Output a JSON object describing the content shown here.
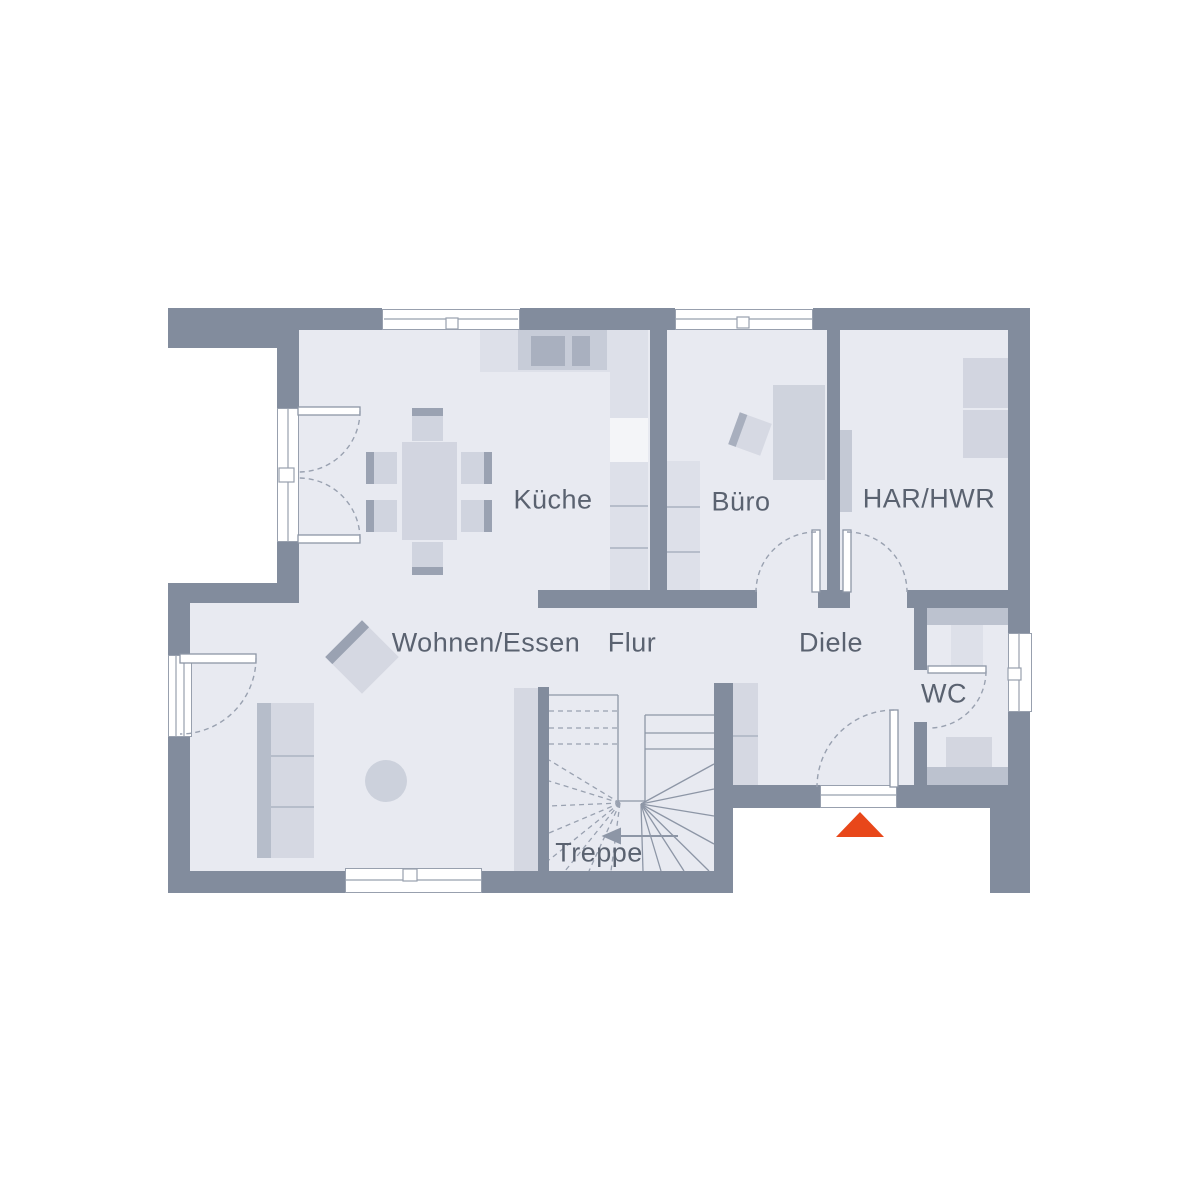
{
  "plan": {
    "type": "floor-plan",
    "rooms": [
      {
        "id": "kueche",
        "label": "Küche"
      },
      {
        "id": "buero",
        "label": "Büro"
      },
      {
        "id": "har_hwr",
        "label": "HAR/HWR"
      },
      {
        "id": "wohnen_essen",
        "label": "Wohnen/Essen"
      },
      {
        "id": "flur",
        "label": "Flur"
      },
      {
        "id": "diele",
        "label": "Diele"
      },
      {
        "id": "wc",
        "label": "WC"
      },
      {
        "id": "treppe",
        "label": "Treppe"
      }
    ],
    "colors": {
      "wall": "#828c9d",
      "floor": "#e8eaf1",
      "label_text": "#5a6270",
      "linework": "#8d96a6",
      "entrance_marker": "#e8471a"
    },
    "entrance_marker": {
      "shape": "triangle-up"
    }
  }
}
